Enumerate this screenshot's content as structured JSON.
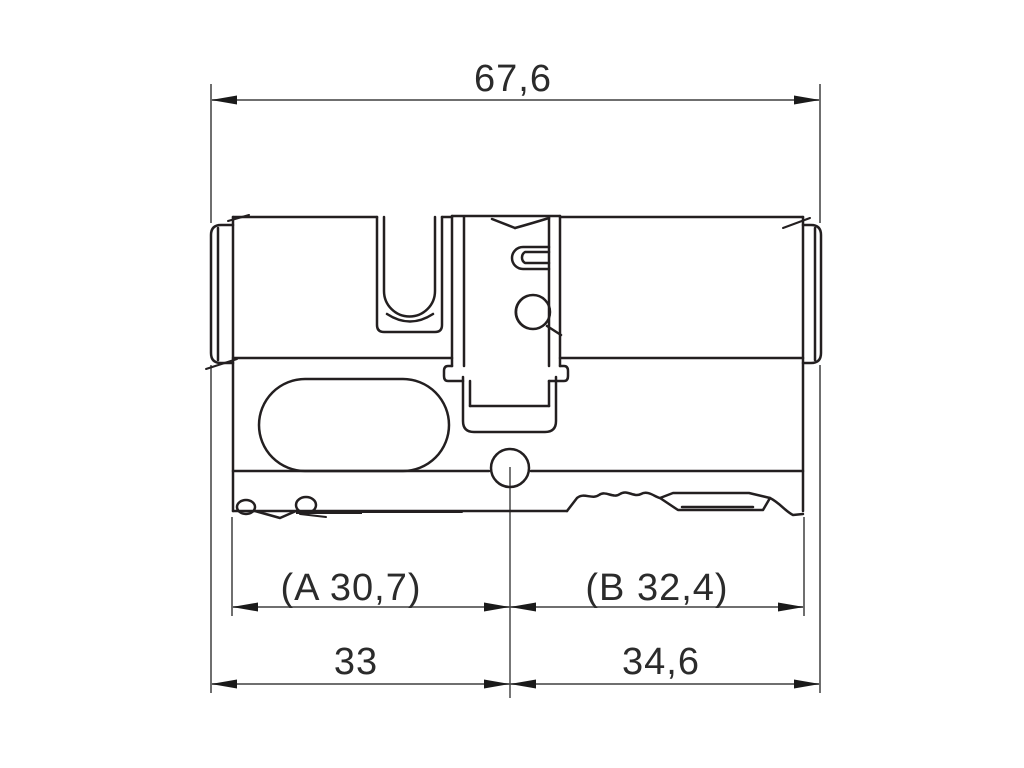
{
  "dimensions": {
    "overall_length": "67,6",
    "a_measure": "(A 30,7)",
    "b_measure": "(B 32,4)",
    "left_length": "33",
    "right_length": "34,6"
  },
  "colors": {
    "background": "#ffffff",
    "part_outline": "#231f20",
    "dimension_line": "#6f6f6f",
    "arrowhead": "#1a1a1a",
    "label_text": "#2b2b2b"
  }
}
